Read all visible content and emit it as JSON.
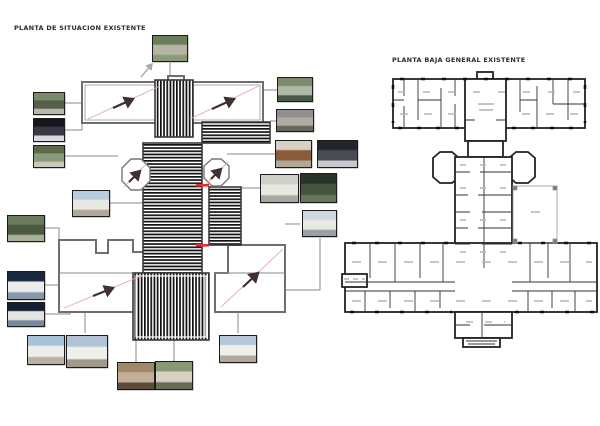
{
  "sheet": {
    "left_plan_title": "PLANTA DE SITUACION EXISTENTE",
    "right_plan_title": "PLANTA BAJA GENERAL EXISTENTE"
  },
  "theme": {
    "background": "#ffffff",
    "wall_color": "#222222",
    "roof_hatch_color": "#111111",
    "outline_gray": "#6e6e6e",
    "connector_gray": "#8a8a8a",
    "sightline_pink": "#e2a9a9",
    "sightline_arrow_dark": "#403030",
    "highlight_red": "#e03030",
    "patio_line": "#9a9a9a",
    "label_smudge": "#b5b5b5"
  },
  "left_plan": {
    "photos": [
      {
        "id": "photo-north-path",
        "x": 152,
        "y": 35,
        "w": 36,
        "h": 27,
        "palette": [
          "#6b7d5a",
          "#b8b4a4",
          "#8a9b7a"
        ]
      },
      {
        "id": "photo-west-garden-1",
        "x": 33,
        "y": 92,
        "w": 32,
        "h": 23,
        "palette": [
          "#7a8a6a",
          "#55604a",
          "#b8b8a8"
        ]
      },
      {
        "id": "photo-west-dark",
        "x": 33,
        "y": 118,
        "w": 32,
        "h": 24,
        "palette": [
          "#16161e",
          "#3a3a44",
          "#d8d8e0"
        ]
      },
      {
        "id": "photo-west-garden-2",
        "x": 33,
        "y": 145,
        "w": 32,
        "h": 23,
        "palette": [
          "#5a6a4a",
          "#8a9b7a",
          "#c9c9bf"
        ]
      },
      {
        "id": "photo-west-courtyard",
        "x": 7,
        "y": 215,
        "w": 38,
        "h": 27,
        "palette": [
          "#6a7a5a",
          "#4a5a40",
          "#a8b098"
        ]
      },
      {
        "id": "photo-inner-west-facade",
        "x": 72,
        "y": 190,
        "w": 38,
        "h": 27,
        "palette": [
          "#b8cce0",
          "#e8e8e2",
          "#b0a898"
        ]
      },
      {
        "id": "photo-southwest-night-1",
        "x": 7,
        "y": 271,
        "w": 38,
        "h": 29,
        "palette": [
          "#18283e",
          "#ececec",
          "#8898a8"
        ]
      },
      {
        "id": "photo-southwest-night-2",
        "x": 7,
        "y": 302,
        "w": 38,
        "h": 25,
        "palette": [
          "#141f33",
          "#e4e4e0",
          "#7888a0"
        ]
      },
      {
        "id": "photo-south-facade-1",
        "x": 27,
        "y": 335,
        "w": 38,
        "h": 30,
        "palette": [
          "#a8c0d8",
          "#ececea",
          "#b8b0a0"
        ]
      },
      {
        "id": "photo-south-facade-2",
        "x": 66,
        "y": 335,
        "w": 42,
        "h": 33,
        "palette": [
          "#b0c4d6",
          "#f0f0ea",
          "#a09a8c"
        ]
      },
      {
        "id": "photo-stone-arch",
        "x": 117,
        "y": 362,
        "w": 38,
        "h": 28,
        "palette": [
          "#a08868",
          "#c4b098",
          "#5a4a38"
        ]
      },
      {
        "id": "photo-main-entrance",
        "x": 155,
        "y": 361,
        "w": 38,
        "h": 29,
        "palette": [
          "#8a9878",
          "#d8d0c0",
          "#6a6a58"
        ]
      },
      {
        "id": "photo-southeast-facade",
        "x": 219,
        "y": 335,
        "w": 38,
        "h": 28,
        "palette": [
          "#b4c8da",
          "#efefe9",
          "#b0a89a"
        ]
      },
      {
        "id": "photo-east-porch-car",
        "x": 277,
        "y": 77,
        "w": 36,
        "h": 25,
        "palette": [
          "#7a8a6a",
          "#b0b8a8",
          "#4a5a48"
        ]
      },
      {
        "id": "photo-east-facade-gray",
        "x": 276,
        "y": 109,
        "w": 38,
        "h": 23,
        "palette": [
          "#909090",
          "#b0aca4",
          "#686860"
        ]
      },
      {
        "id": "photo-east-doors",
        "x": 275,
        "y": 140,
        "w": 37,
        "h": 28,
        "palette": [
          "#d8d0c4",
          "#8a5a3a",
          "#b0a898"
        ]
      },
      {
        "id": "photo-east-dark-shed",
        "x": 317,
        "y": 140,
        "w": 41,
        "h": 28,
        "palette": [
          "#24242c",
          "#4a4a52",
          "#c8c8cc"
        ]
      },
      {
        "id": "photo-gallery-interior",
        "x": 260,
        "y": 174,
        "w": 39,
        "h": 29,
        "palette": [
          "#d0d0ca",
          "#e8e8e2",
          "#a8a89e"
        ]
      },
      {
        "id": "photo-east-trees-dark",
        "x": 300,
        "y": 173,
        "w": 37,
        "h": 30,
        "palette": [
          "#263426",
          "#44543e",
          "#66765e"
        ]
      },
      {
        "id": "photo-east-interior-2",
        "x": 302,
        "y": 210,
        "w": 35,
        "h": 27,
        "palette": [
          "#cfd6dd",
          "#e9e9e3",
          "#9aa0a6"
        ]
      }
    ]
  }
}
